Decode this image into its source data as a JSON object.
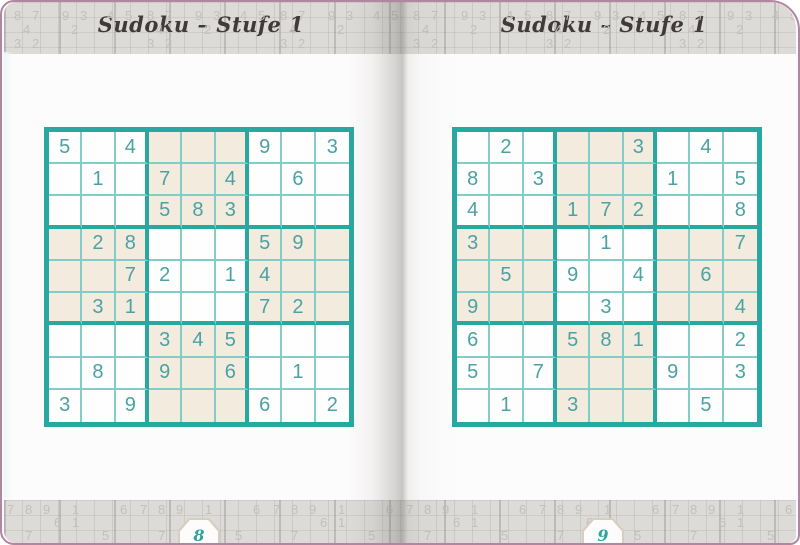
{
  "pages": [
    {
      "title": "Sudoku – Stufe 1",
      "page_number": "8",
      "grid": [
        [
          "5",
          "",
          "4",
          "",
          "",
          "",
          "9",
          "",
          "3"
        ],
        [
          "",
          "1",
          "",
          "7",
          "",
          "4",
          "",
          "6",
          ""
        ],
        [
          "",
          "",
          "",
          "5",
          "8",
          "3",
          "",
          "",
          ""
        ],
        [
          "",
          "2",
          "8",
          "",
          "",
          "",
          "5",
          "9",
          ""
        ],
        [
          "",
          "",
          "7",
          "2",
          "",
          "1",
          "4",
          "",
          ""
        ],
        [
          "",
          "3",
          "1",
          "",
          "",
          "",
          "7",
          "2",
          ""
        ],
        [
          "",
          "",
          "",
          "3",
          "4",
          "5",
          "",
          "",
          ""
        ],
        [
          "",
          "8",
          "",
          "9",
          "",
          "6",
          "",
          "1",
          ""
        ],
        [
          "3",
          "",
          "9",
          "",
          "",
          "",
          "6",
          "",
          "2"
        ]
      ],
      "shaded_blocks": [
        [
          0,
          1
        ],
        [
          1,
          0
        ],
        [
          1,
          2
        ],
        [
          2,
          1
        ]
      ]
    },
    {
      "title": "Sudoku – Stufe 1",
      "page_number": "9",
      "grid": [
        [
          "",
          "2",
          "",
          "",
          "",
          "3",
          "",
          "4",
          ""
        ],
        [
          "8",
          "",
          "3",
          "",
          "",
          "",
          "1",
          "",
          "5"
        ],
        [
          "4",
          "",
          "",
          "1",
          "7",
          "2",
          "",
          "",
          "8"
        ],
        [
          "3",
          "",
          "",
          "",
          "1",
          "",
          "",
          "",
          "7"
        ],
        [
          "",
          "5",
          "",
          "9",
          "",
          "4",
          "",
          "6",
          ""
        ],
        [
          "9",
          "",
          "",
          "",
          "3",
          "",
          "",
          "",
          "4"
        ],
        [
          "6",
          "",
          "",
          "5",
          "8",
          "1",
          "",
          "",
          "2"
        ],
        [
          "5",
          "",
          "7",
          "",
          "",
          "",
          "9",
          "",
          "3"
        ],
        [
          "",
          "1",
          "",
          "3",
          "",
          "",
          "",
          "5",
          ""
        ]
      ],
      "shaded_blocks": [
        [
          0,
          1
        ],
        [
          1,
          0
        ],
        [
          1,
          2
        ],
        [
          2,
          1
        ]
      ]
    }
  ],
  "background": {
    "top": {
      "repeat": 6,
      "tile_width": 133,
      "row_y": [
        7,
        21,
        35
      ],
      "numbers": [
        {
          "x": 10,
          "row": 0,
          "t": "8"
        },
        {
          "x": 28,
          "row": 0,
          "t": "7"
        },
        {
          "x": 58,
          "row": 0,
          "t": "9"
        },
        {
          "x": 76,
          "row": 0,
          "t": "3"
        },
        {
          "x": 103,
          "row": 0,
          "t": "4"
        },
        {
          "x": 121,
          "row": 0,
          "t": "5"
        },
        {
          "x": 19,
          "row": 1,
          "t": "4"
        },
        {
          "x": 67,
          "row": 1,
          "t": "2"
        },
        {
          "x": 10,
          "row": 2,
          "t": "3"
        },
        {
          "x": 28,
          "row": 2,
          "t": "2"
        }
      ]
    },
    "bottom": {
      "repeat": 6,
      "tile_width": 133,
      "row_y": [
        3,
        16,
        29
      ],
      "numbers": [
        {
          "x": 3,
          "row": 0,
          "t": "7"
        },
        {
          "x": 21,
          "row": 0,
          "t": "8"
        },
        {
          "x": 39,
          "row": 0,
          "t": "9"
        },
        {
          "x": 68,
          "row": 0,
          "t": "1"
        },
        {
          "x": 116,
          "row": 0,
          "t": "6"
        },
        {
          "x": 50,
          "row": 1,
          "t": "6"
        },
        {
          "x": 68,
          "row": 1,
          "t": "1"
        },
        {
          "x": 21,
          "row": 2,
          "t": "7"
        },
        {
          "x": 98,
          "row": 2,
          "t": "5"
        }
      ]
    }
  },
  "colors": {
    "grid_border_teal": "#29a7a1",
    "grid_thin_line": "#82cdc8",
    "digit_teal": "#4aa2a2",
    "shaded_cell": "#f4ebdf",
    "band_gray": "#dcdbd8",
    "cover_edge_mauve": "#b286a0",
    "page_number_teal": "#2ea49e",
    "title_ink": "#403a3a"
  }
}
